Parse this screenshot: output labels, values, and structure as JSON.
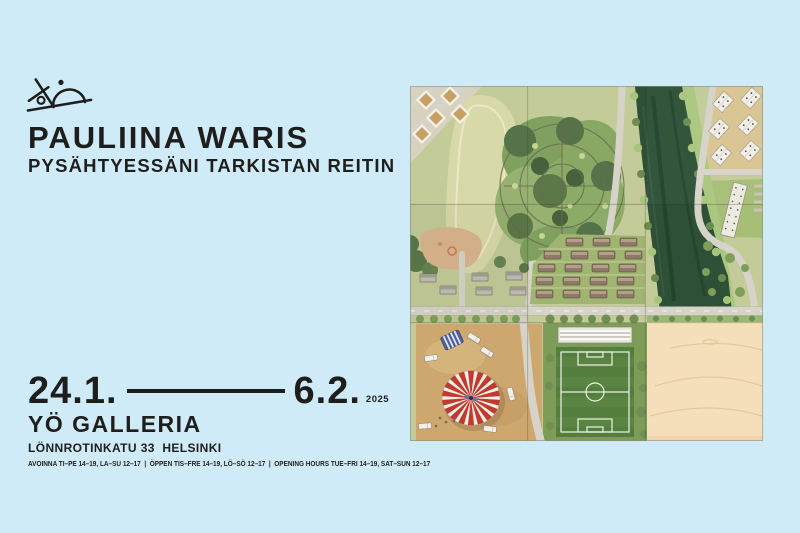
{
  "colors": {
    "background": "#d0ebf8",
    "text": "#1e1e1c",
    "tent_red": "#c23a2e",
    "river_green": "#2d5036",
    "wood_panel": "#f4dfba"
  },
  "header": {
    "artist": "PAULIINA WARIS",
    "exhibition_title": "PYSÄHTYESSÄNI TARKISTAN REITIN",
    "logo_icon": "figure-pushing-dome-uphill-icon"
  },
  "dates": {
    "start": "24.1.",
    "end": "6.2.",
    "year": "2025"
  },
  "venue": {
    "name": "YÖ GALLERIA",
    "address": "LÖNNROTINKATU 33  HELSINKI"
  },
  "hours": {
    "combined": "AVOINNA TI–PE 14–19, LA–SU 12–17  |  ÖPPEN TIS–FRE 14–19, LÖ–SÖ 12–17  |  OPENING HOURS TUE–FRI 14–19, SAT–SUN 12–17"
  },
  "artwork": {
    "alt": "aerial-map-painting-on-nine-wood-panels"
  }
}
